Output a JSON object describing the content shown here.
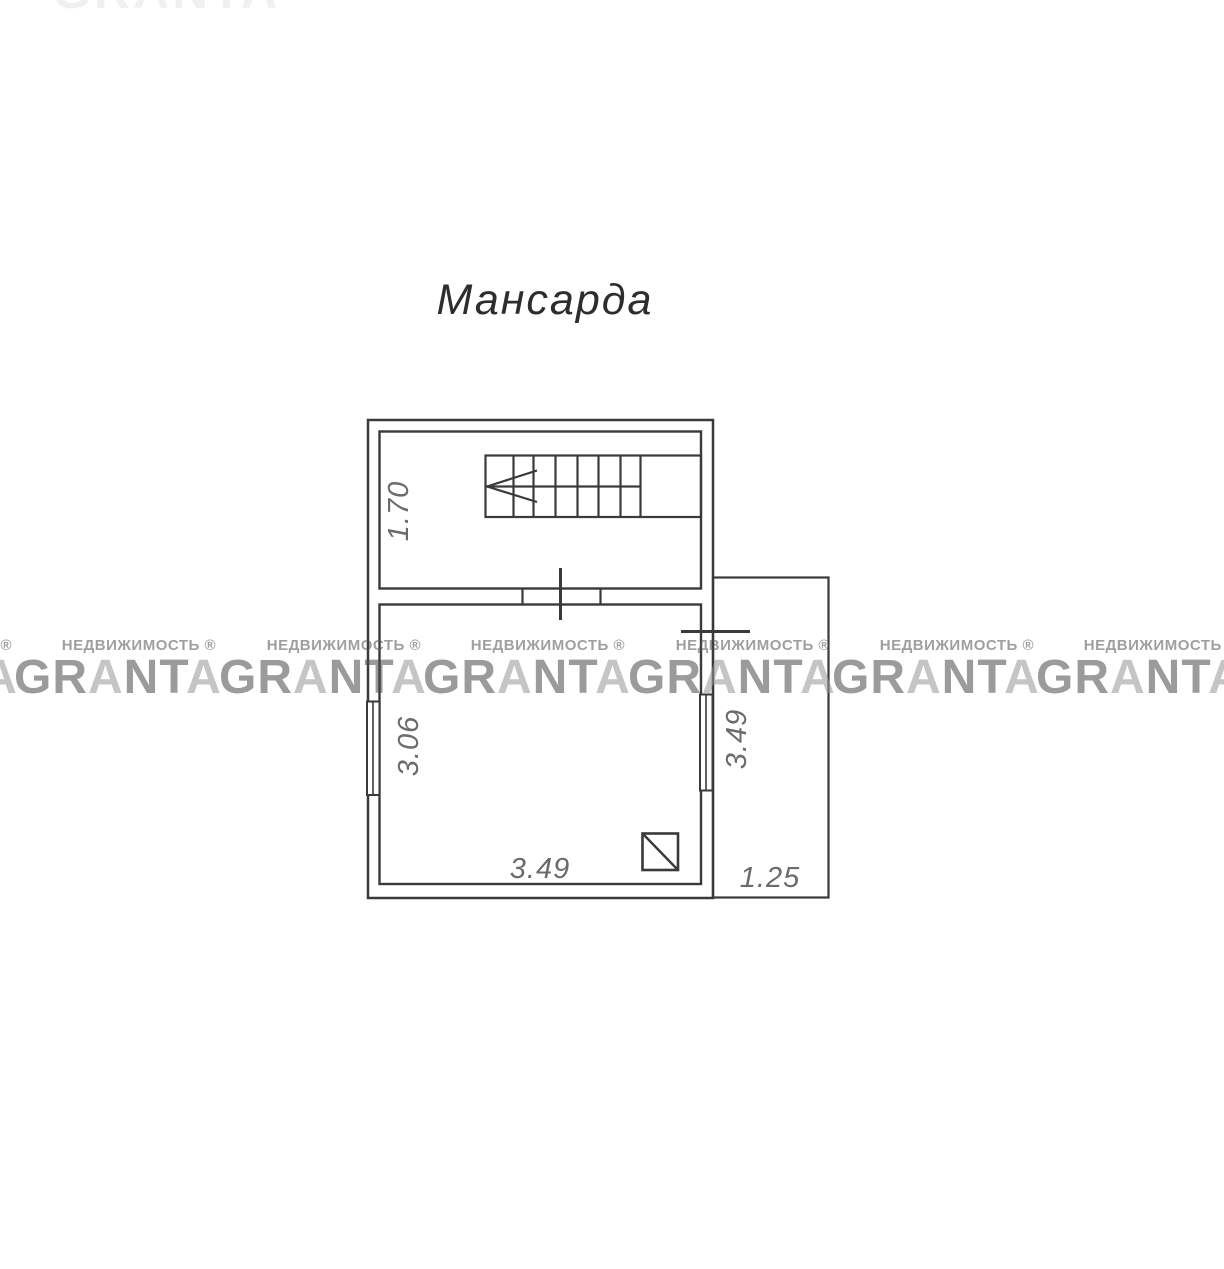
{
  "page": {
    "background_color": "#ffffff",
    "line_color": "#3a3a3a",
    "dim_text_color": "#6b6b6b",
    "title_text_color": "#2d2d2d"
  },
  "title": "Мансарда",
  "dimensions": [
    {
      "id": "stair-room-depth",
      "value": "1.70",
      "orientation": "vertical"
    },
    {
      "id": "main-room-left",
      "value": "3.06",
      "orientation": "vertical"
    },
    {
      "id": "main-room-right",
      "value": "3.49",
      "orientation": "vertical"
    },
    {
      "id": "main-room-bottom",
      "value": "3.49",
      "orientation": "horizontal"
    },
    {
      "id": "balcony-bottom",
      "value": "1.25",
      "orientation": "horizontal"
    }
  ],
  "watermark": {
    "subtext": "НЕДВИЖИМОСТЬ ®",
    "brand_full": "GRANTA",
    "brand_gr": "GR",
    "brand_a": "A",
    "brand_nt": "NT",
    "brand_a2": "A",
    "brand_dark_color": "#9b9b9b",
    "brand_light_color": "#c4c4c4"
  }
}
